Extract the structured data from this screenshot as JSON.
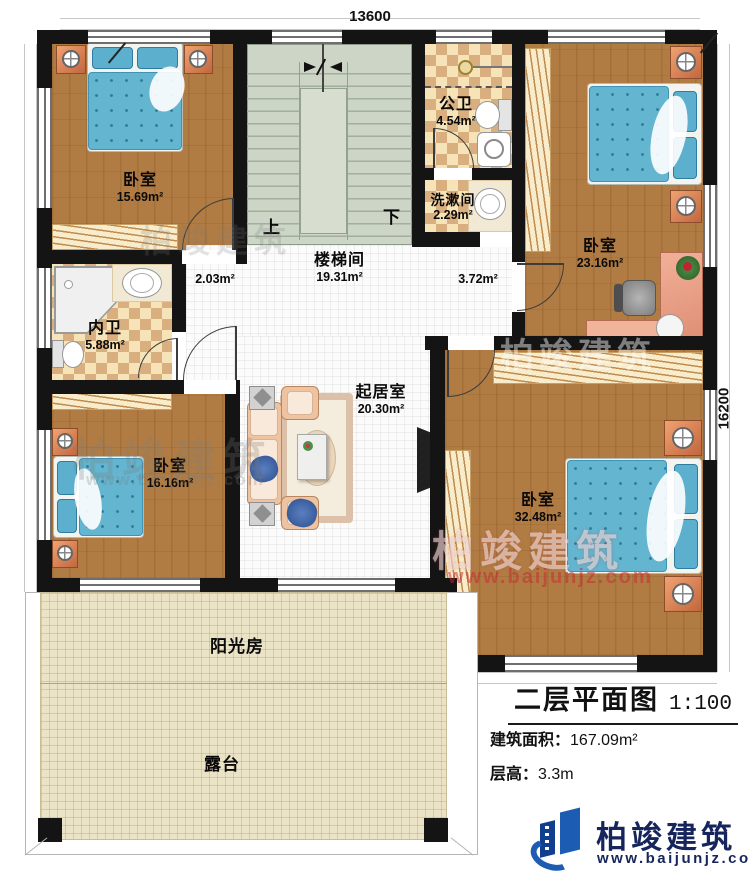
{
  "dimensions": {
    "width_label": "13600",
    "height_label": "16200"
  },
  "stairs": {
    "up_label": "上",
    "down_label": "下"
  },
  "rooms": {
    "bedroom_top_left": {
      "name": "卧室",
      "area": "15.69m²"
    },
    "bedroom_top_right": {
      "name": "卧室",
      "area": "23.16m²"
    },
    "bedroom_bottom_left": {
      "name": "卧室",
      "area": "16.16m²"
    },
    "bedroom_bottom_right": {
      "name": "卧室",
      "area": "32.48m²"
    },
    "stairwell": {
      "name": "楼梯间",
      "area": "19.31m²"
    },
    "public_bathroom": {
      "name": "公卫",
      "area": "4.54m²"
    },
    "washroom": {
      "name": "洗漱间",
      "area": "2.29m²"
    },
    "private_bathroom": {
      "name": "内卫",
      "area": "5.88m²"
    },
    "living_room": {
      "name": "起居室",
      "area": "20.30m²"
    },
    "hall_west": {
      "area": "2.03m²"
    },
    "hall_east": {
      "area": "3.72m²"
    },
    "sunroom": {
      "name": "阳光房"
    },
    "terrace": {
      "name": "露台"
    }
  },
  "title_block": {
    "title": "二层平面图",
    "scale": "1:100",
    "building_area_label": "建筑面积：",
    "building_area_value": "167.09m²",
    "floor_height_label": "层高：",
    "floor_height_value": "3.3m"
  },
  "brand": {
    "name": "柏竣建筑",
    "website": "www.baijunjz.com"
  },
  "colors": {
    "wall": "#141414",
    "wood_floor": "#b17c43",
    "checker_light": "#f6e3b7",
    "checker_dark": "#d9af7f",
    "stair": "#ccd5c6",
    "bed_blue": "#63b5d0",
    "nightstand": "#d98a5f",
    "logo_blue": "#1d5cb3",
    "watermark_red": "#c82732"
  }
}
